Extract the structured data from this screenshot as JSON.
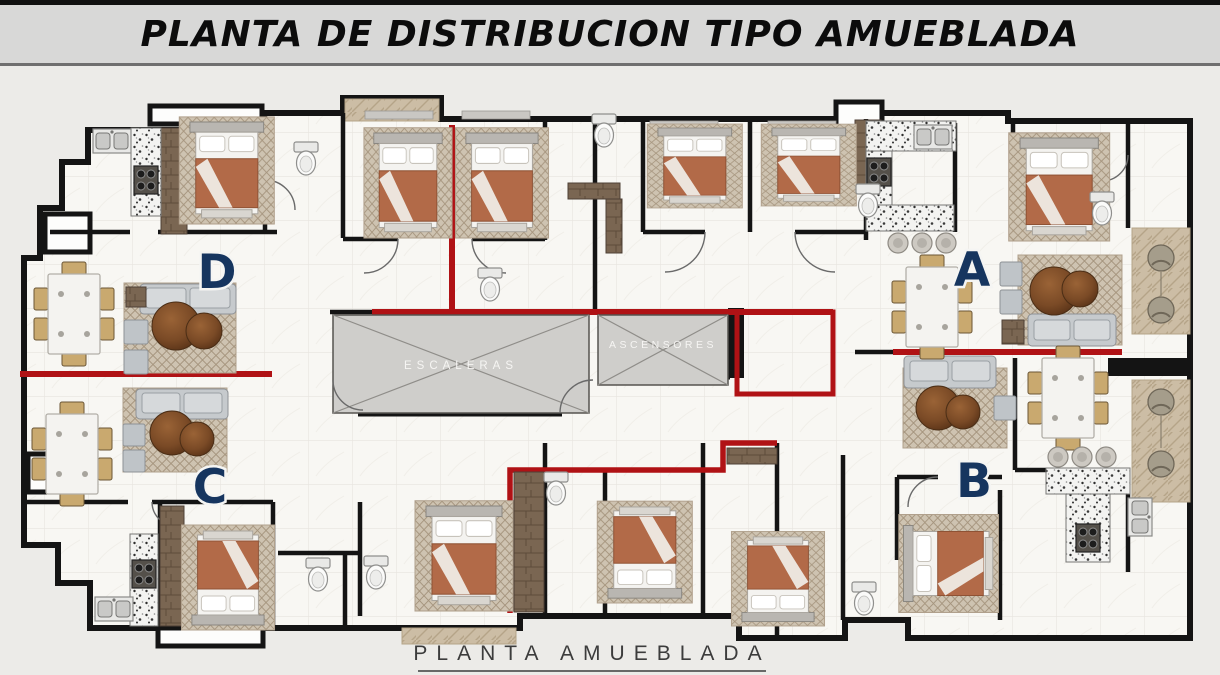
{
  "header": {
    "title": "PLANTA DE DISTRIBUCION TIPO AMUEBLADA"
  },
  "plan": {
    "stairs_label": "ESCALERAS",
    "elevators_label": "ASCENSORES",
    "units": [
      {
        "label": "A"
      },
      {
        "label": "B"
      },
      {
        "label": "C"
      },
      {
        "label": "D"
      }
    ],
    "caption": "PLANTA AMUEBLADA",
    "colors": {
      "header_bg": "#d8d8d7",
      "wall_black": "#141414",
      "unit_divider_red": "#b01215",
      "unit_label_navy": "#16355f",
      "core_fill_gray": "#cfcecb",
      "floor": "#f8f7f3"
    }
  }
}
